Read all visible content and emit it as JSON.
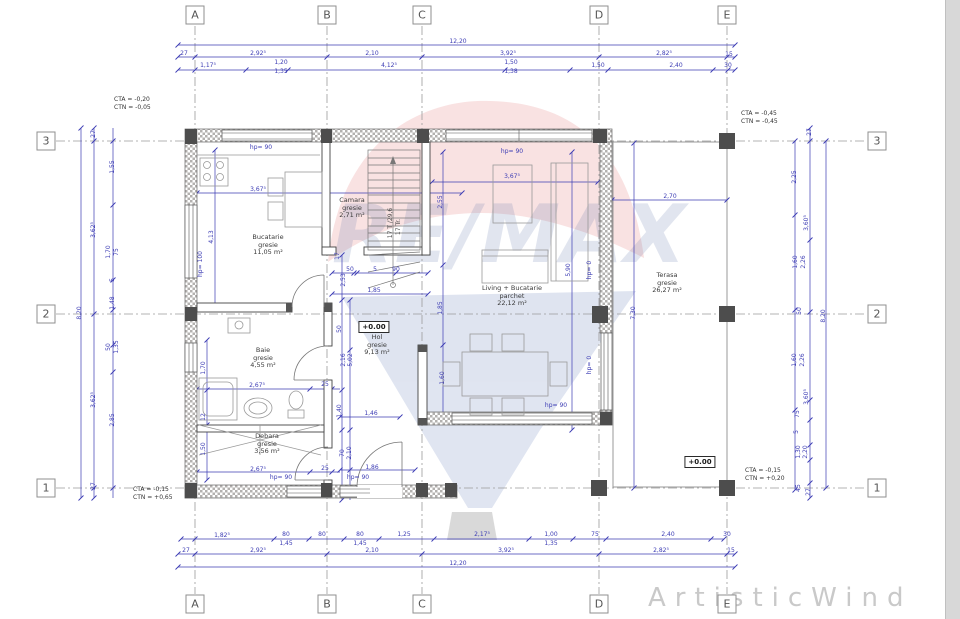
{
  "grid": {
    "cols": [
      {
        "label": "A",
        "x": 195
      },
      {
        "label": "B",
        "x": 327
      },
      {
        "label": "C",
        "x": 422
      },
      {
        "label": "D",
        "x": 599
      },
      {
        "label": "E",
        "x": 727
      }
    ],
    "rows": [
      {
        "label": "3",
        "y": 141
      },
      {
        "label": "2",
        "y": 314
      },
      {
        "label": "1",
        "y": 488
      }
    ]
  },
  "rooms": [
    {
      "name": "Bucatarie",
      "finish": "gresie",
      "area": "11,05 m²",
      "x": 268,
      "y": 245
    },
    {
      "name": "Camara",
      "finish": "gresie",
      "area": "2,71 m²",
      "x": 352,
      "y": 208
    },
    {
      "name": "Living + Bucatarie",
      "finish": "parchet",
      "area": "22,12 m²",
      "x": 512,
      "y": 296
    },
    {
      "name": "Hol",
      "finish": "gresie",
      "area": "9,13 m²",
      "x": 377,
      "y": 345
    },
    {
      "name": "Baie",
      "finish": "gresie",
      "area": "4,55 m²",
      "x": 263,
      "y": 358
    },
    {
      "name": "Debara",
      "finish": "gresie",
      "area": "3,56 m²",
      "x": 267,
      "y": 444
    },
    {
      "name": "Terasa",
      "finish": "gresie",
      "area": "26,27 m²",
      "x": 667,
      "y": 283
    }
  ],
  "levels": [
    {
      "text": "+0.00",
      "x": 374,
      "y": 327
    },
    {
      "text": "+0.00",
      "x": 700,
      "y": 462
    }
  ],
  "elevations": [
    {
      "line1": "CTA = -0,20",
      "line2": "CTN = -0,05",
      "x": 114,
      "y": 96
    },
    {
      "line1": "CTA = -0,45",
      "line2": "CTN = -0,45",
      "x": 741,
      "y": 110
    },
    {
      "line1": "CTA = -0,15",
      "line2": "CTN = +0,65",
      "x": 133,
      "y": 486
    },
    {
      "line1": "CTA = -0,15",
      "line2": "CTN = +0,20",
      "x": 745,
      "y": 467
    }
  ],
  "watermark": {
    "brand": "RE/MAX",
    "red": "#d93a3a",
    "blue": "#2d4f9e",
    "corner_text": "ArtisticWind"
  },
  "dim_labels": [
    {
      "t": "12,20",
      "x": 458,
      "y": 42
    },
    {
      "t": "27",
      "x": 184,
      "y": 54
    },
    {
      "t": "2,92⁵",
      "x": 258,
      "y": 54
    },
    {
      "t": "2,10",
      "x": 372,
      "y": 54
    },
    {
      "t": "3,92⁵",
      "x": 508,
      "y": 54
    },
    {
      "t": "2,82⁵",
      "x": 664,
      "y": 54
    },
    {
      "t": "15",
      "x": 729,
      "y": 55
    },
    {
      "t": "1,17⁵",
      "x": 208,
      "y": 66
    },
    {
      "t": "1,20",
      "x": 281,
      "y": 63
    },
    {
      "t": "1,35",
      "x": 281,
      "y": 72
    },
    {
      "t": "4,12⁵",
      "x": 389,
      "y": 66
    },
    {
      "t": "1,50",
      "x": 511,
      "y": 63
    },
    {
      "t": "1,38",
      "x": 511,
      "y": 72
    },
    {
      "t": "1,50",
      "x": 598,
      "y": 66
    },
    {
      "t": "2,40",
      "x": 676,
      "y": 66
    },
    {
      "t": "30",
      "x": 728,
      "y": 66
    },
    {
      "t": "1,82⁵",
      "x": 222,
      "y": 536
    },
    {
      "t": "80",
      "x": 286,
      "y": 535
    },
    {
      "t": "1,45",
      "x": 286,
      "y": 544
    },
    {
      "t": "80",
      "x": 322,
      "y": 535
    },
    {
      "t": "80",
      "x": 360,
      "y": 535
    },
    {
      "t": "1,45",
      "x": 360,
      "y": 544
    },
    {
      "t": "1,25",
      "x": 404,
      "y": 535
    },
    {
      "t": "2,17⁵",
      "x": 482,
      "y": 535
    },
    {
      "t": "1,00",
      "x": 551,
      "y": 535
    },
    {
      "t": "1,35",
      "x": 551,
      "y": 544
    },
    {
      "t": "75",
      "x": 595,
      "y": 535
    },
    {
      "t": "2,40",
      "x": 668,
      "y": 535
    },
    {
      "t": "30",
      "x": 727,
      "y": 535
    },
    {
      "t": "27",
      "x": 186,
      "y": 551
    },
    {
      "t": "2,92⁵",
      "x": 258,
      "y": 551
    },
    {
      "t": "2,10",
      "x": 372,
      "y": 551
    },
    {
      "t": "3,92⁵",
      "x": 506,
      "y": 551
    },
    {
      "t": "2,82⁵",
      "x": 661,
      "y": 551
    },
    {
      "t": "15",
      "x": 731,
      "y": 551
    },
    {
      "t": "12,20",
      "x": 458,
      "y": 564
    },
    {
      "t": "8,20",
      "x": 80,
      "y": 313,
      "r": -90
    },
    {
      "t": "27",
      "x": 94,
      "y": 134,
      "r": -90
    },
    {
      "t": "3,62⁵",
      "x": 94,
      "y": 230,
      "r": -90
    },
    {
      "t": "3,62⁵",
      "x": 94,
      "y": 400,
      "r": -90
    },
    {
      "t": "27",
      "x": 94,
      "y": 486,
      "r": -90
    },
    {
      "t": "1,55",
      "x": 113,
      "y": 167,
      "r": -90
    },
    {
      "t": "1,70",
      "x": 109,
      "y": 252,
      "r": -90
    },
    {
      "t": "75",
      "x": 117,
      "y": 252,
      "r": -90
    },
    {
      "t": "5",
      "x": 113,
      "y": 280,
      "r": -90
    },
    {
      "t": "1,48",
      "x": 113,
      "y": 303,
      "r": -90
    },
    {
      "t": "50",
      "x": 109,
      "y": 347,
      "r": -90
    },
    {
      "t": "1,35",
      "x": 117,
      "y": 347,
      "r": -90
    },
    {
      "t": "2,85",
      "x": 113,
      "y": 420,
      "r": -90
    },
    {
      "t": "27",
      "x": 810,
      "y": 132,
      "r": -90
    },
    {
      "t": "2,25",
      "x": 795,
      "y": 177,
      "r": -90
    },
    {
      "t": "3,60⁵",
      "x": 807,
      "y": 223,
      "r": -90
    },
    {
      "t": "1,60",
      "x": 796,
      "y": 262,
      "r": -90
    },
    {
      "t": "2,26",
      "x": 804,
      "y": 262,
      "r": -90
    },
    {
      "t": "50",
      "x": 800,
      "y": 311,
      "r": -90
    },
    {
      "t": "8,20",
      "x": 824,
      "y": 316,
      "r": -90
    },
    {
      "t": "1,60",
      "x": 795,
      "y": 360,
      "r": -90
    },
    {
      "t": "2,26",
      "x": 803,
      "y": 360,
      "r": -90
    },
    {
      "t": "3,60⁵",
      "x": 807,
      "y": 397,
      "r": -90
    },
    {
      "t": "75",
      "x": 798,
      "y": 414,
      "r": -90
    },
    {
      "t": "5",
      "x": 797,
      "y": 432,
      "r": -90
    },
    {
      "t": "1,30",
      "x": 799,
      "y": 452,
      "r": -90
    },
    {
      "t": "2,20",
      "x": 806,
      "y": 452,
      "r": -90
    },
    {
      "t": "45",
      "x": 799,
      "y": 488,
      "r": -90
    },
    {
      "t": "27",
      "x": 809,
      "y": 492,
      "r": -90
    },
    {
      "t": "hp= 90",
      "x": 261,
      "y": 148
    },
    {
      "t": "hp= 90",
      "x": 512,
      "y": 152
    },
    {
      "t": "hp= 90",
      "x": 556,
      "y": 406
    },
    {
      "t": "hp= 90",
      "x": 281,
      "y": 478
    },
    {
      "t": "hp= 90",
      "x": 358,
      "y": 478
    },
    {
      "t": "hp= 100",
      "x": 201,
      "y": 264,
      "r": -90
    },
    {
      "t": "hp= 0",
      "x": 590,
      "y": 270,
      "r": -90
    },
    {
      "t": "hp= 0",
      "x": 590,
      "y": 365,
      "r": -90
    },
    {
      "t": "3,67⁵",
      "x": 258,
      "y": 190
    },
    {
      "t": "3,67⁵",
      "x": 512,
      "y": 177
    },
    {
      "t": "2,70",
      "x": 670,
      "y": 197
    },
    {
      "t": "4,13",
      "x": 212,
      "y": 237,
      "r": -90
    },
    {
      "t": "2,55",
      "x": 441,
      "y": 202,
      "r": -90
    },
    {
      "t": "1,85",
      "x": 441,
      "y": 308,
      "r": -90
    },
    {
      "t": "1,60",
      "x": 443,
      "y": 378,
      "r": -90
    },
    {
      "t": "5,90",
      "x": 569,
      "y": 270,
      "r": -90
    },
    {
      "t": "7,30",
      "x": 634,
      "y": 313,
      "r": -90
    },
    {
      "t": "2,53",
      "x": 344,
      "y": 280,
      "r": -90
    },
    {
      "t": "17",
      "x": 338,
      "y": 256,
      "r": -90
    },
    {
      "t": "50",
      "x": 350,
      "y": 270
    },
    {
      "t": "5",
      "x": 375,
      "y": 270
    },
    {
      "t": "90",
      "x": 396,
      "y": 270
    },
    {
      "t": "1,85",
      "x": 374,
      "y": 291
    },
    {
      "t": "50",
      "x": 340,
      "y": 329,
      "r": -90
    },
    {
      "t": "2,16",
      "x": 344,
      "y": 360,
      "r": -90
    },
    {
      "t": "5,02",
      "x": 351,
      "y": 360,
      "r": -90
    },
    {
      "t": "1,40",
      "x": 340,
      "y": 411,
      "r": -90
    },
    {
      "t": "1,46",
      "x": 371,
      "y": 414
    },
    {
      "t": "2,67⁵",
      "x": 257,
      "y": 386
    },
    {
      "t": "25",
      "x": 325,
      "y": 385
    },
    {
      "t": "2,67⁵",
      "x": 258,
      "y": 470
    },
    {
      "t": "25",
      "x": 325,
      "y": 469
    },
    {
      "t": "1,86",
      "x": 372,
      "y": 468
    },
    {
      "t": "70",
      "x": 343,
      "y": 453,
      "r": -90
    },
    {
      "t": "2,10",
      "x": 350,
      "y": 453,
      "r": -90
    },
    {
      "t": "1,70",
      "x": 204,
      "y": 368,
      "r": -90
    },
    {
      "t": "12",
      "x": 204,
      "y": 417,
      "r": -90
    },
    {
      "t": "1,50",
      "x": 204,
      "y": 449,
      "r": -90
    },
    {
      "t": "17 T /29,6",
      "x": 391,
      "y": 223,
      "r": -90,
      "c": "note"
    },
    {
      "t": "17 Tr.",
      "x": 399,
      "y": 227,
      "r": -90,
      "c": "note"
    }
  ]
}
